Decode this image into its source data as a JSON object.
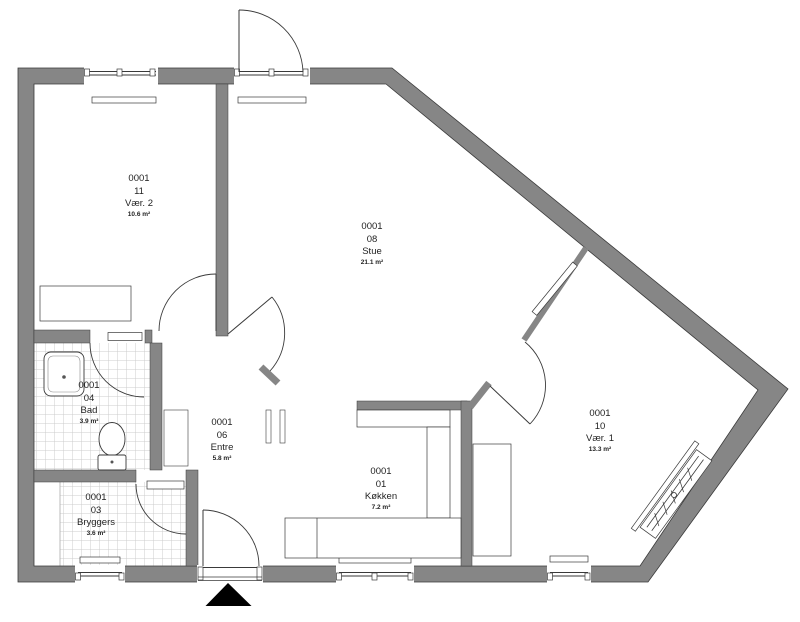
{
  "rooms": [
    {
      "id": "0001",
      "number": "11",
      "name": "Vær. 2",
      "area": "10.6 m²"
    },
    {
      "id": "0001",
      "number": "08",
      "name": "Stue",
      "area": "21.1 m²"
    },
    {
      "id": "0001",
      "number": "04",
      "name": "Bad",
      "area": "3.9 m²"
    },
    {
      "id": "0001",
      "number": "06",
      "name": "Entre",
      "area": "5.8 m²"
    },
    {
      "id": "0001",
      "number": "03",
      "name": "Bryggers",
      "area": "3.6 m²"
    },
    {
      "id": "0001",
      "number": "01",
      "name": "Køkken",
      "area": "7.2 m²"
    },
    {
      "id": "0001",
      "number": "10",
      "name": "Vær. 1",
      "area": "13.3 m²"
    }
  ],
  "colors": {
    "wall": "#868686",
    "line": "#3a3a3a",
    "tile": "#cccccc",
    "marker": "#000000",
    "text": "#1f1f1f",
    "bg": "#ffffff"
  }
}
